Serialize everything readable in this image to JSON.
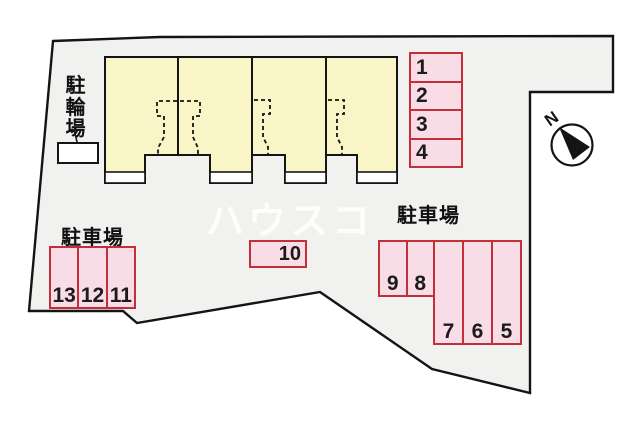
{
  "colors": {
    "site-fill": "#f1f1ef",
    "line": "#141414",
    "building-fill": "#faf5c6",
    "space-fill": "#f8dce6",
    "space-border": "#c22f3a",
    "porch-fill": "#ffffff"
  },
  "labels": {
    "bicycle_parking": "駐輪場",
    "parking_left": "駐車場",
    "parking_right": "駐車場"
  },
  "compass": {
    "north": "N"
  },
  "watermark": {
    "text": "ハウスコ"
  },
  "parking_groups": {
    "east_column": {
      "spaces": [
        "1",
        "2",
        "3",
        "4"
      ]
    },
    "southwest_row": {
      "spaces": [
        "13",
        "12",
        "11"
      ]
    },
    "center_single": {
      "spaces": [
        "10"
      ]
    },
    "south_short_row": {
      "spaces": [
        "9",
        "8"
      ]
    },
    "south_tall_row": {
      "spaces": [
        "7",
        "6",
        "5"
      ]
    }
  }
}
